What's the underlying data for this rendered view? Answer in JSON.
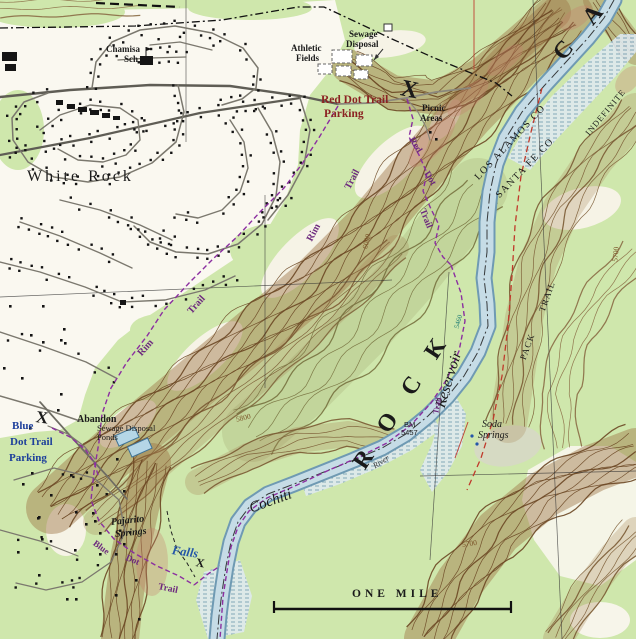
{
  "labels": {
    "town": "White Rock",
    "school_line1": "Chamisa",
    "school_line2": "Sch",
    "sewage_line1": "Sewage",
    "sewage_line2": "Disposal",
    "athletic_line1": "Athletic",
    "athletic_line2": "Fields",
    "red_dot_parking_line1": "Red Dot Trail",
    "red_dot_parking_line2": "Parking",
    "picnic_line1": "Picnic",
    "picnic_line2": "Areas",
    "x_red_dot": "X",
    "x_blue_dot": "X",
    "x_falls": "X",
    "red_dot_word1": "Red",
    "red_dot_word2": "Dot",
    "red_dot_word3": "Trail",
    "rim_upper": "Rim",
    "trail_upper": "Trail",
    "rim_lower": "Rim",
    "trail_lower": "Trail",
    "county_los_alamos": "LOS ALAMOS CO",
    "county_santa_fe": "SANTA FE CO",
    "canyon_rock": "R O C K",
    "canyon_ca": "C A",
    "indefinite": "INDEFINITE",
    "reservoir": "Reservoir",
    "cochiti": "Cochiti",
    "river": "River",
    "river_trail": "Trail",
    "pack": "PACK",
    "pack_trail": "TRAIL",
    "bm_line1": "BM",
    "bm_line2": "5457",
    "soda_line1": "Soda",
    "soda_line2": "Springs",
    "blue_parking_line1": "Blue",
    "blue_parking_line2": "Dot Trail",
    "blue_parking_line3": "Parking",
    "abandon_line1": "Abandon",
    "abandon_line2": "Sewage Disposal",
    "abandon_line3": "Ponds",
    "pajarito_line1": "Pajarito",
    "pajarito_line2": "Springs",
    "blue_dot_word1": "Blue",
    "blue_dot_word2": "Dot",
    "falls": "Falls",
    "falls_trail": "Trail",
    "contour_6000": "6000",
    "contour_5800": "5800",
    "contour_5700_east": "5700",
    "contour_5700_south": "5700",
    "contour_5460": "5460",
    "scale_bar": "ONE MILE"
  },
  "colors": {
    "vegetation": "#cfe7ac",
    "water": "#c6dce6",
    "contour_brown": "#6b4723",
    "trail_purple": "#8b2fa0",
    "pack_trail_red": "#c0392b",
    "label_red": "#8b2222",
    "label_blue": "#1d3f9b",
    "falls_blue": "#2456a8",
    "county_line": "#111111"
  }
}
